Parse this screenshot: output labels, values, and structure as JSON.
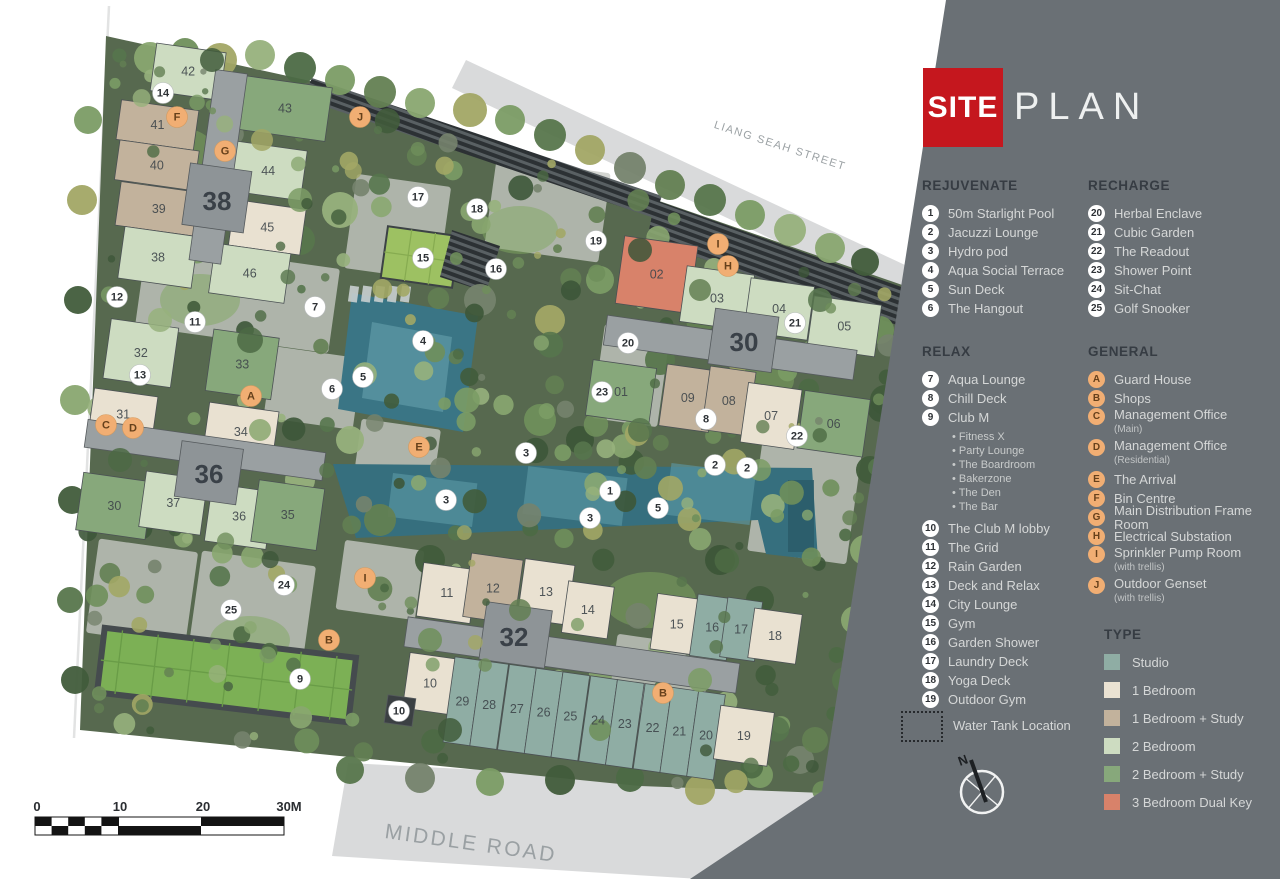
{
  "header": {
    "title_primary": "SITE",
    "title_secondary": "PLAN"
  },
  "legend": {
    "rejuvenate": {
      "heading": "REJUVENATE",
      "items": [
        {
          "n": "1",
          "label": "50m Starlight Pool"
        },
        {
          "n": "2",
          "label": "Jacuzzi Lounge"
        },
        {
          "n": "3",
          "label": "Hydro pod"
        },
        {
          "n": "4",
          "label": "Aqua Social Terrace"
        },
        {
          "n": "5",
          "label": "Sun Deck"
        },
        {
          "n": "6",
          "label": "The Hangout"
        }
      ]
    },
    "recharge": {
      "heading": "RECHARGE",
      "items": [
        {
          "n": "20",
          "label": "Herbal Enclave"
        },
        {
          "n": "21",
          "label": "Cubic Garden"
        },
        {
          "n": "22",
          "label": "The Readout"
        },
        {
          "n": "23",
          "label": "Shower Point"
        },
        {
          "n": "24",
          "label": "Sit-Chat"
        },
        {
          "n": "25",
          "label": "Golf Snooker"
        }
      ]
    },
    "relax": {
      "heading": "RELAX",
      "items": [
        {
          "n": "7",
          "label": "Aqua Lounge"
        },
        {
          "n": "8",
          "label": "Chill Deck"
        },
        {
          "n": "9",
          "label": "Club M",
          "subs": [
            "Fitness X",
            "Party Lounge",
            "The Boardroom",
            "Bakerzone",
            "The Den",
            "The Bar"
          ]
        },
        {
          "n": "10",
          "label": "The Club M lobby"
        },
        {
          "n": "11",
          "label": "The Grid"
        },
        {
          "n": "12",
          "label": "Rain Garden"
        },
        {
          "n": "13",
          "label": "Deck and Relax"
        },
        {
          "n": "14",
          "label": "City Lounge"
        },
        {
          "n": "15",
          "label": "Gym"
        },
        {
          "n": "16",
          "label": "Garden Shower"
        },
        {
          "n": "17",
          "label": "Laundry Deck"
        },
        {
          "n": "18",
          "label": "Yoga Deck"
        },
        {
          "n": "19",
          "label": "Outdoor Gym"
        }
      ]
    },
    "general": {
      "heading": "GENERAL",
      "items": [
        {
          "n": "A",
          "label": "Guard House"
        },
        {
          "n": "B",
          "label": "Shops"
        },
        {
          "n": "C",
          "label": "Management Office",
          "note": "(Main)"
        },
        {
          "n": "D",
          "label": "Management Office",
          "note": "(Residential)"
        },
        {
          "n": "E",
          "label": "The Arrival"
        },
        {
          "n": "F",
          "label": "Bin Centre"
        },
        {
          "n": "G",
          "label": "Main Distribution Frame Room"
        },
        {
          "n": "H",
          "label": "Electrical Substation"
        },
        {
          "n": "I",
          "label": "Sprinkler Pump Room",
          "note": "(with trellis)"
        },
        {
          "n": "J",
          "label": "Outdoor Genset",
          "note": "(with trellis)"
        }
      ]
    },
    "type": {
      "heading": "TYPE",
      "items": [
        {
          "label": "Studio",
          "color": "#8fada4"
        },
        {
          "label": "1 Bedroom",
          "color": "#eae2d2"
        },
        {
          "label": "1 Bedroom + Study",
          "color": "#c2b29c"
        },
        {
          "label": "2 Bedroom",
          "color": "#cddcc1"
        },
        {
          "label": "2 Bedroom + Study",
          "color": "#87a87b"
        },
        {
          "label": "3 Bedroom Dual Key",
          "color": "#d8826a"
        }
      ]
    },
    "water_tank_label": "Water Tank Location",
    "compass_label": "N"
  },
  "colors": {
    "panel": "#6a7075",
    "title_red": "#c5171e",
    "site_green": "#57694f",
    "marker_num_bg": "#ffffff",
    "marker_num_text": "#2e3236",
    "marker_let_bg": "#f1ae73",
    "marker_let_text": "#66401b",
    "types": {
      "studio": "#8fada4",
      "b1": "#e9e1d1",
      "b1s": "#c2b29c",
      "b2": "#cddcc1",
      "b2s": "#87a87b",
      "b3dk": "#d8826a",
      "core": "#9aa0a2",
      "core2": "#8e9497",
      "dark": "#3b4043"
    }
  },
  "map": {
    "streets": [
      {
        "name": "LIANG SEAH STREET",
        "x": 779,
        "y": 149,
        "rot": 18,
        "size": 11,
        "ls": 1.5
      },
      {
        "name": "MIDDLE ROAD",
        "x": 470,
        "y": 850,
        "rot": 8,
        "size": 21,
        "ls": 2.5
      }
    ],
    "scale_bar": {
      "labels": [
        {
          "t": "0",
          "x": 37
        },
        {
          "t": "10",
          "x": 120
        },
        {
          "t": "20",
          "x": 203
        },
        {
          "t": "30M",
          "x": 289
        }
      ],
      "y": 811
    },
    "clusters": [
      {
        "name": "38",
        "lx": 217,
        "ly": 201,
        "cx": 212,
        "cy": 168,
        "rot": 8,
        "units": [
          {
            "n": "42",
            "x": -72,
            "y": -116,
            "w": 70,
            "h": 48,
            "t": "b2"
          },
          {
            "n": "41",
            "x": -99,
            "y": -55,
            "w": 78,
            "h": 40,
            "t": "b1s"
          },
          {
            "n": "40",
            "x": -95,
            "y": -15,
            "w": 80,
            "h": 40,
            "t": "b1s"
          },
          {
            "n": "39",
            "x": -88,
            "y": 26,
            "w": 82,
            "h": 44,
            "t": "b1s"
          },
          {
            "n": "38",
            "x": -78,
            "y": 70,
            "w": 74,
            "h": 52,
            "t": "b2"
          },
          {
            "n": "43",
            "x": 20,
            "y": -96,
            "w": 88,
            "h": 54,
            "t": "b2s"
          },
          {
            "n": "44",
            "x": 20,
            "y": -30,
            "w": 72,
            "h": 50,
            "t": "b2"
          },
          {
            "n": "45",
            "x": 27,
            "y": 28,
            "w": 72,
            "h": 46,
            "t": "b1"
          },
          {
            "n": "46",
            "x": 14,
            "y": 74,
            "w": 76,
            "h": 50,
            "t": "b2"
          },
          {
            "x": -10,
            "y": -98,
            "w": 32,
            "h": 192,
            "t": "core"
          },
          {
            "x": -22,
            "y": -2,
            "w": 62,
            "h": 62,
            "t": "core2"
          }
        ]
      },
      {
        "name": "36",
        "lx": 209,
        "ly": 474,
        "cx": 205,
        "cy": 450,
        "rot": 8,
        "units": [
          {
            "n": "32",
            "x": -111,
            "y": -117,
            "w": 68,
            "h": 60,
            "t": "b2"
          },
          {
            "n": "33",
            "x": -8,
            "y": -121,
            "w": 66,
            "h": 62,
            "t": "b2s"
          },
          {
            "n": "31",
            "x": -118,
            "y": -46,
            "w": 64,
            "h": 44,
            "t": "b1"
          },
          {
            "n": "34",
            "x": -2,
            "y": -48,
            "w": 70,
            "h": 50,
            "t": "b1"
          },
          {
            "n": "30",
            "x": -117,
            "y": 39,
            "w": 70,
            "h": 58,
            "t": "b2s"
          },
          {
            "n": "37",
            "x": -55,
            "y": 29,
            "w": 62,
            "h": 56,
            "t": "b2"
          },
          {
            "n": "36",
            "x": 12,
            "y": 32,
            "w": 62,
            "h": 58,
            "t": "b2"
          },
          {
            "n": "35",
            "x": 58,
            "y": 22,
            "w": 66,
            "h": 62,
            "t": "b2s"
          },
          {
            "x": -120,
            "y": -14,
            "w": 240,
            "h": 28,
            "t": "core"
          },
          {
            "x": -24,
            "y": -6,
            "w": 62,
            "h": 56,
            "t": "core2"
          }
        ]
      },
      {
        "name": "30",
        "lx": 744,
        "ly": 342,
        "cx": 740,
        "cy": 350,
        "rot": 8,
        "units": [
          {
            "n": "02",
            "x": -130,
            "y": -97,
            "w": 74,
            "h": 68,
            "t": "b3dk"
          },
          {
            "n": "03",
            "x": -64,
            "y": -76,
            "w": 68,
            "h": 56,
            "t": "b2"
          },
          {
            "n": "04",
            "x": 1,
            "y": -73,
            "w": 64,
            "h": 54,
            "t": "b2"
          },
          {
            "n": "05",
            "x": 66,
            "y": -64,
            "w": 68,
            "h": 52,
            "t": "b2"
          },
          {
            "n": "01",
            "x": -144,
            "y": 30,
            "w": 64,
            "h": 56,
            "t": "b2s"
          },
          {
            "n": "09",
            "x": -70,
            "y": 24,
            "w": 50,
            "h": 62,
            "t": "b1s"
          },
          {
            "n": "08",
            "x": -27,
            "y": 20,
            "w": 46,
            "h": 64,
            "t": "b1s"
          },
          {
            "n": "07",
            "x": 13,
            "y": 31,
            "w": 54,
            "h": 60,
            "t": "b1"
          },
          {
            "n": "06",
            "x": 70,
            "y": 31,
            "w": 66,
            "h": 58,
            "t": "b2s"
          },
          {
            "x": -136,
            "y": -16,
            "w": 252,
            "h": 30,
            "t": "core"
          },
          {
            "x": -30,
            "y": -38,
            "w": 64,
            "h": 56,
            "t": "core2"
          }
        ]
      },
      {
        "name": "32",
        "lx": 514,
        "ly": 637,
        "cx": 600,
        "cy": 660,
        "rot": 8,
        "units": [
          {
            "n": "11",
            "x": -188,
            "y": -72,
            "w": 54,
            "h": 54,
            "t": "b1"
          },
          {
            "n": "12",
            "x": -142,
            "y": -88,
            "w": 52,
            "h": 64,
            "t": "b1s"
          },
          {
            "n": "13",
            "x": -88,
            "y": -90,
            "w": 50,
            "h": 60,
            "t": "b1"
          },
          {
            "n": "14",
            "x": -42,
            "y": -74,
            "w": 46,
            "h": 52,
            "t": "b1"
          },
          {
            "n": "15",
            "x": 48,
            "y": -74,
            "w": 46,
            "h": 56,
            "t": "b1"
          },
          {
            "n": "16",
            "x": 88,
            "y": -79,
            "w": 37,
            "h": 62,
            "t": "studio"
          },
          {
            "n": "17",
            "x": 118,
            "y": -80,
            "w": 35,
            "h": 60,
            "t": "studio"
          },
          {
            "n": "18",
            "x": 146,
            "y": -73,
            "w": 48,
            "h": 50,
            "t": "b1"
          },
          {
            "n": "10",
            "x": -189,
            "y": 19,
            "w": 48,
            "h": 56,
            "t": "b1"
          },
          {
            "n": "29",
            "x": -144,
            "y": 17,
            "w": 27,
            "h": 86,
            "t": "studio"
          },
          {
            "n": "28",
            "x": -117,
            "y": 17,
            "w": 27,
            "h": 86,
            "t": "studio"
          },
          {
            "n": "27",
            "x": -89,
            "y": 17,
            "w": 27,
            "h": 86,
            "t": "studio"
          },
          {
            "n": "26",
            "x": -62,
            "y": 17,
            "w": 27,
            "h": 86,
            "t": "studio"
          },
          {
            "n": "25",
            "x": -35,
            "y": 17,
            "w": 27,
            "h": 86,
            "t": "studio"
          },
          {
            "n": "24",
            "x": -7,
            "y": 17,
            "w": 27,
            "h": 86,
            "t": "studio"
          },
          {
            "n": "23",
            "x": 20,
            "y": 17,
            "w": 27,
            "h": 86,
            "t": "studio"
          },
          {
            "n": "22",
            "x": 48,
            "y": 17,
            "w": 27,
            "h": 86,
            "t": "studio"
          },
          {
            "n": "21",
            "x": 75,
            "y": 17,
            "w": 27,
            "h": 86,
            "t": "studio"
          },
          {
            "n": "20",
            "x": 102,
            "y": 17,
            "w": 27,
            "h": 86,
            "t": "studio"
          },
          {
            "n": "19",
            "x": 126,
            "y": 28,
            "w": 54,
            "h": 54,
            "t": "b1"
          },
          {
            "x": -196,
            "y": -16,
            "w": 335,
            "h": 30,
            "t": "core"
          },
          {
            "x": -205,
            "y": 64,
            "w": 28,
            "h": 28,
            "t": "dark"
          },
          {
            "x": -120,
            "y": -42,
            "w": 66,
            "h": 58,
            "t": "core2"
          }
        ]
      }
    ],
    "markers": [
      {
        "k": "num",
        "n": "1",
        "x": 610,
        "y": 491
      },
      {
        "k": "num",
        "n": "2",
        "x": 715,
        "y": 465
      },
      {
        "k": "num",
        "n": "2",
        "x": 747,
        "y": 468
      },
      {
        "k": "num",
        "n": "3",
        "x": 526,
        "y": 453
      },
      {
        "k": "num",
        "n": "3",
        "x": 446,
        "y": 500
      },
      {
        "k": "num",
        "n": "3",
        "x": 590,
        "y": 518
      },
      {
        "k": "num",
        "n": "4",
        "x": 423,
        "y": 341
      },
      {
        "k": "num",
        "n": "5",
        "x": 363,
        "y": 377
      },
      {
        "k": "num",
        "n": "5",
        "x": 658,
        "y": 508
      },
      {
        "k": "num",
        "n": "6",
        "x": 332,
        "y": 389
      },
      {
        "k": "num",
        "n": "7",
        "x": 315,
        "y": 307
      },
      {
        "k": "num",
        "n": "8",
        "x": 706,
        "y": 419
      },
      {
        "k": "num",
        "n": "9",
        "x": 300,
        "y": 679
      },
      {
        "k": "num",
        "n": "10",
        "x": 399,
        "y": 711
      },
      {
        "k": "num",
        "n": "11",
        "x": 195,
        "y": 322
      },
      {
        "k": "num",
        "n": "12",
        "x": 117,
        "y": 297
      },
      {
        "k": "num",
        "n": "13",
        "x": 140,
        "y": 375
      },
      {
        "k": "num",
        "n": "14",
        "x": 163,
        "y": 93
      },
      {
        "k": "num",
        "n": "15",
        "x": 423,
        "y": 258
      },
      {
        "k": "num",
        "n": "16",
        "x": 496,
        "y": 269
      },
      {
        "k": "num",
        "n": "17",
        "x": 418,
        "y": 197
      },
      {
        "k": "num",
        "n": "18",
        "x": 477,
        "y": 209
      },
      {
        "k": "num",
        "n": "19",
        "x": 596,
        "y": 241
      },
      {
        "k": "num",
        "n": "20",
        "x": 628,
        "y": 343
      },
      {
        "k": "num",
        "n": "21",
        "x": 795,
        "y": 323
      },
      {
        "k": "num",
        "n": "22",
        "x": 797,
        "y": 436
      },
      {
        "k": "num",
        "n": "23",
        "x": 602,
        "y": 392
      },
      {
        "k": "num",
        "n": "24",
        "x": 284,
        "y": 585
      },
      {
        "k": "num",
        "n": "25",
        "x": 231,
        "y": 610
      },
      {
        "k": "let",
        "n": "A",
        "x": 251,
        "y": 396
      },
      {
        "k": "let",
        "n": "B",
        "x": 329,
        "y": 640
      },
      {
        "k": "let",
        "n": "B",
        "x": 663,
        "y": 693
      },
      {
        "k": "let",
        "n": "C",
        "x": 106,
        "y": 425
      },
      {
        "k": "let",
        "n": "D",
        "x": 133,
        "y": 428
      },
      {
        "k": "let",
        "n": "E",
        "x": 419,
        "y": 447
      },
      {
        "k": "let",
        "n": "F",
        "x": 177,
        "y": 117
      },
      {
        "k": "let",
        "n": "G",
        "x": 225,
        "y": 151
      },
      {
        "k": "let",
        "n": "H",
        "x": 728,
        "y": 266
      },
      {
        "k": "let",
        "n": "I",
        "x": 718,
        "y": 244
      },
      {
        "k": "let",
        "n": "I",
        "x": 365,
        "y": 578
      },
      {
        "k": "let",
        "n": "J",
        "x": 360,
        "y": 117
      }
    ]
  }
}
